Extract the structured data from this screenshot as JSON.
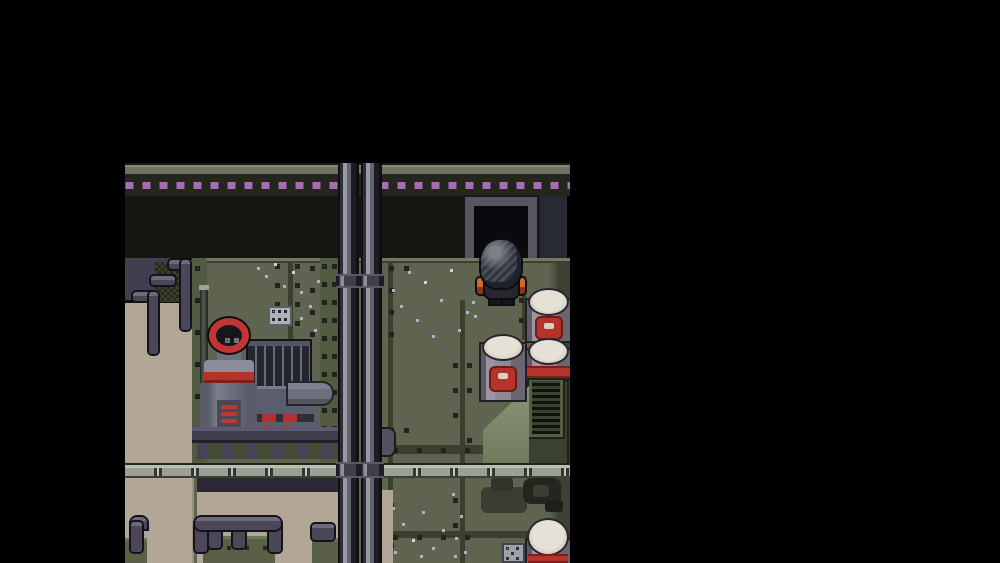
{
  "window": {
    "title": "Stealth action game — letterboxed gameplay screenshot",
    "hud_text": []
  },
  "scene": {
    "description": "Top-down pixel-art industrial interior: metal riveted walls, doorway, character standing by barrels, boiler machine, catwalks, vertical pipes and bench frames",
    "entities": [
      "ceiling-edge-bar",
      "purple-indicator-lights",
      "dark-upper-wall",
      "doorway",
      "player-character",
      "storage-barrels",
      "boiler-machine-with-red-ring",
      "stair-railing",
      "tan-lower-wall",
      "vertical-pipes",
      "segmented-handrail",
      "vented-crate",
      "floor-machinery-gears",
      "bench-frames",
      "wall-vent-plates"
    ],
    "player": {
      "sprite": "soldier-back-view-spiky-hair",
      "accent_items": "orange side pouches"
    },
    "barrel_count_visible": 4
  },
  "colors": {
    "black": "#000000",
    "ceiling-bar": "#6f7366",
    "band-bg": "#23261b",
    "light-purple": "#a76cb6",
    "purple-dark": "#6a4278",
    "upper-wall": "#141710",
    "door-frame": "#56565e",
    "door-opening": "#0a0a0e",
    "side-panel": "#272935",
    "wall-base": "#5e6450",
    "wall-edge": "#747a60",
    "seam": "#3a3f2e",
    "rivet": "#22251a",
    "speckle": "#aab4c4",
    "speckle-bright": "#ccd4dc",
    "tan": "#b2a797",
    "tower": "#433e4f",
    "tube": "#4b4758",
    "tube-hi": "#6e6a7c",
    "tube-outline": "#14121a",
    "mesh-a": "#39402e",
    "mesh-b": "#262b1e",
    "pillar": "#525a42",
    "stud": "#20231a",
    "pipe-dark": "#101014",
    "pipe-mid": "#63636f",
    "pipe-hi": "#9a9aa5",
    "rail-base": "#9aa094",
    "rail-dark": "#343831",
    "rail-hi": "#c2c7bd",
    "platform": "#403c4b",
    "platform-post": "#474254",
    "shadow-band": "#2c2935",
    "ring-red": "#c23535",
    "ring-inner": "#17161c",
    "machine-light": "#8b8e9a",
    "machine-mid": "#6d707c",
    "machine-dark": "#474a56",
    "vent-red": "#c23535",
    "fin-dark": "#23262e",
    "fin-light": "#52565f",
    "box-gray": "#5a5d6d",
    "crate-dark": "#3b4130",
    "crate-face": "#717a5c",
    "grille-bg": "#10130c",
    "grille-slat": "#3c4230",
    "grille-frame": "#565d45",
    "gear-dark": "#23261e",
    "gear-mid": "#3a3e31",
    "plate-gray": "#aab2ba",
    "barrel-body": "#8e8995",
    "barrel-shadow": "#6a6571",
    "barrel-top": "#d0cabe",
    "barrel-top-hi": "#e6e1d6",
    "barrel-red": "#b5332b",
    "barrel-red-dark": "#7e1f1a",
    "player-outline": "#0c0d10",
    "player-body": "#26272e",
    "hair-dark": "#2e323c",
    "hair-mid": "#474c56",
    "hair-hi": "#7c8089",
    "pad-orange": "#cf6a2d",
    "pad-dark": "#8a3518",
    "bench-box": "#596047",
    "bench-box-top": "#6f7557"
  }
}
